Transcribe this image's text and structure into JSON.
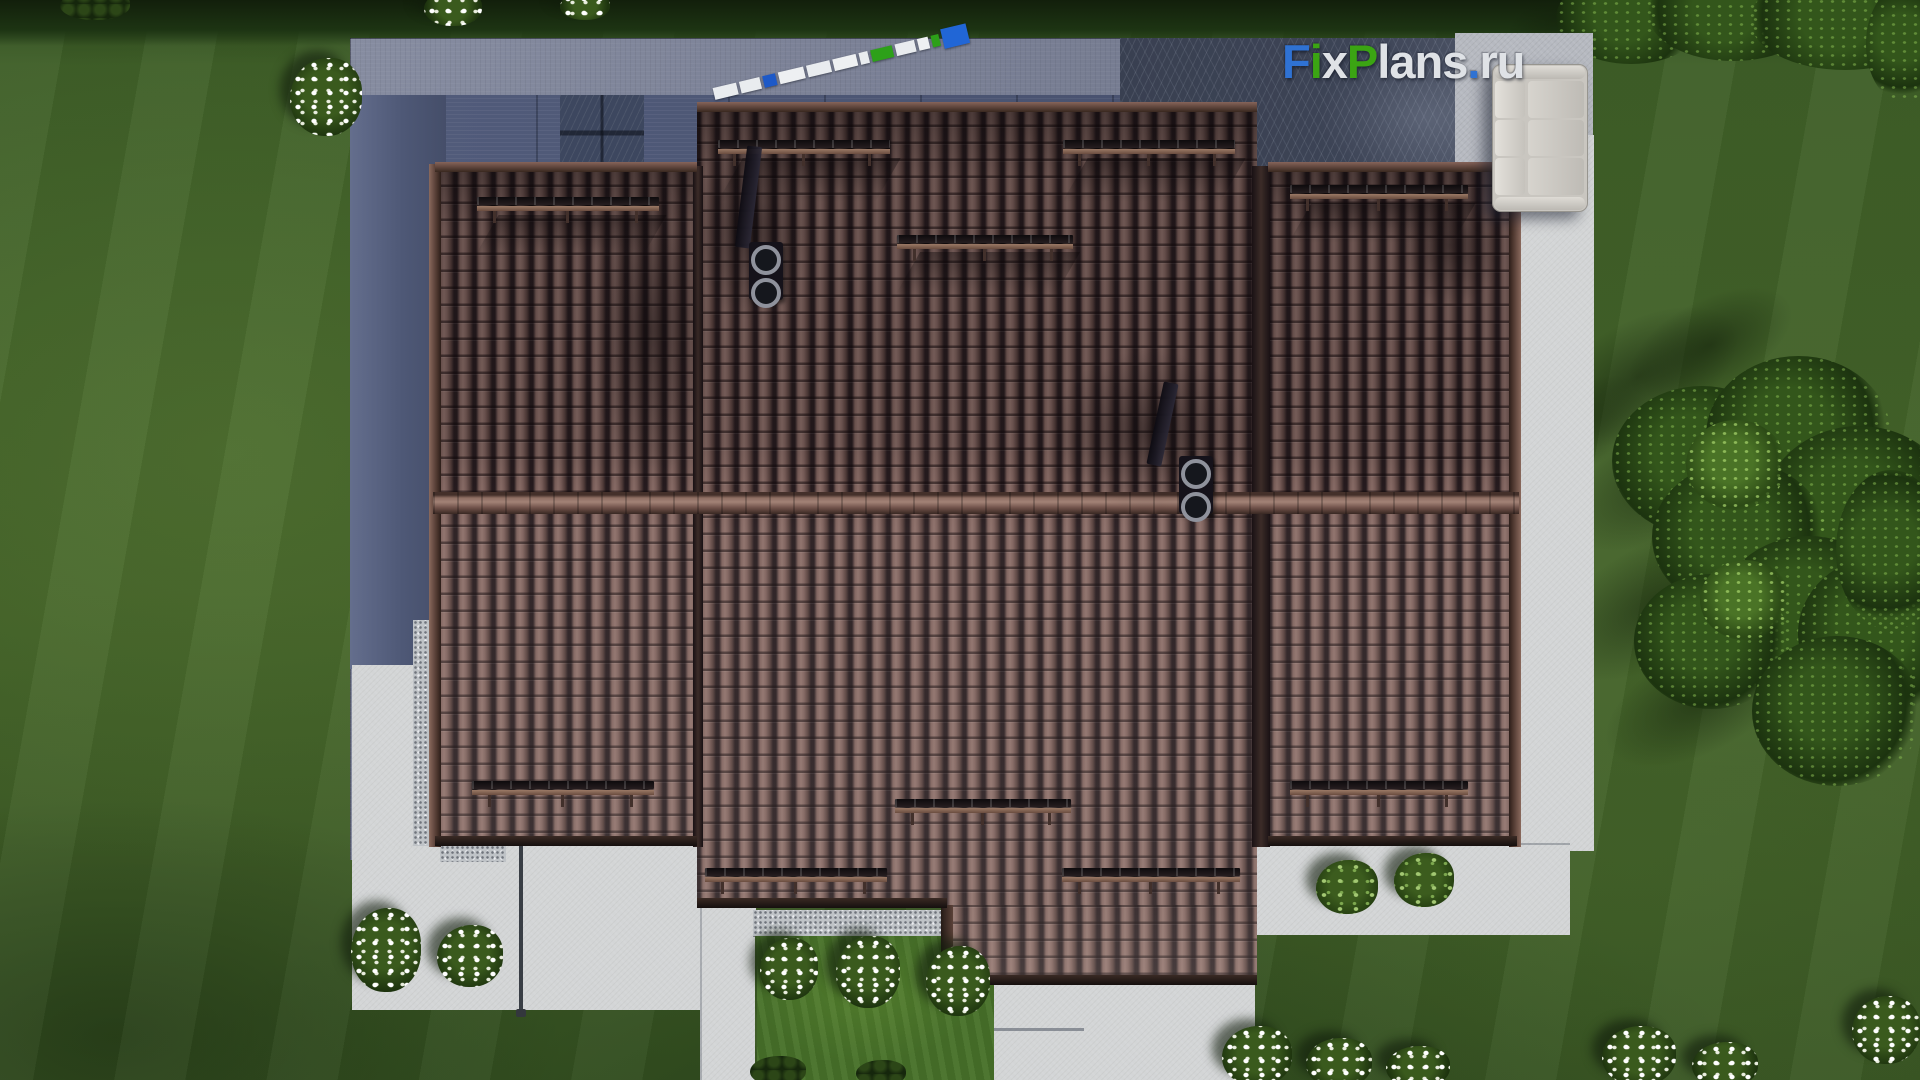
{
  "watermark": {
    "text": "FixPlans.ru",
    "parts": [
      {
        "text": "F",
        "style": "color:#2f72d3"
      },
      {
        "text": "i",
        "style": "color:#3ba413"
      },
      {
        "text": "x",
        "style": "color:#dfe2e6"
      },
      {
        "text": "P",
        "style": "color:#3ba413"
      },
      {
        "text": "lans",
        "style": "color:#dfe2e6"
      },
      {
        "text": ".",
        "style": "color:#2f72d3"
      },
      {
        "text": "ru",
        "style": "color:#dfe2e6"
      }
    ]
  },
  "palette": {
    "lawn": "#446329",
    "lawn_bright": "#4f7c2a",
    "roof_tile": "#7d615c",
    "roof_gap": "#271c1f",
    "ridge": "#8f6f64",
    "pavement_blue": "#7b8196",
    "pavement_dark": "#3a4153",
    "concrete": "#d3d5d6",
    "granite": "#bfc3c7",
    "shadow_blue": "#4e5876",
    "logo_blue": "#2f72d3",
    "logo_green": "#3ba413",
    "logo_white": "#dfe2e6",
    "ruler_white": "#e9ecef",
    "ruler_blue": "#1d59c8",
    "ruler_green": "#2da019",
    "tree_green": "#1c330f",
    "flower_white": "#ffffff"
  },
  "scene": {
    "ruler_segments": [
      {
        "style": "width:24px;background:#e9ecef"
      },
      {
        "style": "width:21px;background:#e9ecef"
      },
      {
        "style": "width:13px;background:#1d59c8"
      },
      {
        "style": "width:26px;background:#eef0f2"
      },
      {
        "style": "width:24px;background:#e9ecef"
      },
      {
        "style": "width:24px;background:#eef0f2"
      },
      {
        "style": "width:9px;background:#e9ecef"
      },
      {
        "style": "width:22px;background:#2da019"
      },
      {
        "style": "width:20px;background:#e9ecef"
      },
      {
        "style": "width:11px;background:#eef0f2"
      },
      {
        "style": "width:8px;background:#2da019"
      },
      {
        "style": "width:26px;background:#2166d6",
        "cls": "tip"
      }
    ],
    "snow_guards": [
      {
        "style": "left:477px;top:197px;width:182px"
      },
      {
        "style": "left:718px;top:140px;width:172px"
      },
      {
        "style": "left:1063px;top:140px;width:172px"
      },
      {
        "style": "left:897px;top:235px;width:176px"
      },
      {
        "style": "left:1290px;top:185px;width:178px"
      },
      {
        "style": "left:472px;top:781px;width:182px"
      },
      {
        "style": "left:895px;top:799px;width:176px"
      },
      {
        "style": "left:705px;top:868px;width:182px"
      },
      {
        "style": "left:1062px;top:868px;width:178px"
      },
      {
        "style": "left:1290px;top:781px;width:178px"
      }
    ],
    "roof_shadows": [
      {
        "style": "left:1050px;top:350px;width:200px;height:160px"
      },
      {
        "style": "left:690px;top:140px;width:120px;height:180px"
      },
      {
        "style": "left:590px;top:180px;width:120px;height:300px"
      },
      {
        "style": "left:1395px;top:185px;width:110px;height:120px"
      }
    ],
    "roof_streaks": [
      {
        "style": "left:730px;top:158px;width:158px;height:44px"
      },
      {
        "style": "left:1075px;top:158px;width:158px;height:44px"
      },
      {
        "style": "left:908px;top:252px;width:160px;height:42px"
      },
      {
        "style": "left:487px;top:215px;width:168px;height:40px"
      },
      {
        "style": "left:1300px;top:203px;width:164px;height:40px"
      }
    ],
    "flower_bushes": [
      {
        "style": "left:290px;top:58px;width:72px;height:78px"
      },
      {
        "style": "left:424px;top:-10px;width:58px;height:36px"
      },
      {
        "style": "left:560px;top:-8px;width:50px;height:28px"
      },
      {
        "style": "left:351px;top:908px;width:70px;height:84px"
      },
      {
        "style": "left:437px;top:925px;width:66px;height:62px"
      },
      {
        "style": "left:760px;top:938px;width:58px;height:62px"
      },
      {
        "style": "left:836px;top:936px;width:64px;height:72px"
      },
      {
        "style": "left:926px;top:946px;width:64px;height:70px"
      },
      {
        "style": "left:1222px;top:1026px;width:70px;height:60px"
      },
      {
        "style": "left:1306px;top:1038px;width:66px;height:50px"
      },
      {
        "style": "left:1386px;top:1046px;width:64px;height:42px"
      },
      {
        "style": "left:1602px;top:1026px;width:74px;height:60px"
      },
      {
        "style": "left:1692px;top:1042px;width:66px;height:46px"
      },
      {
        "style": "left:1852px;top:996px;width:68px;height:68px"
      },
      {
        "style": "left:1316px;top:860px;width:62px;height:54px",
        "cls": "green"
      },
      {
        "style": "left:1394px;top:853px;width:60px;height:54px",
        "cls": "green"
      },
      {
        "style": "left:750px;top:1056px;width:56px;height:30px",
        "cls": "dark"
      },
      {
        "style": "left:856px;top:1060px;width:50px;height:26px",
        "cls": "dark"
      },
      {
        "style": "left:60px;top:-10px;width:70px;height:30px",
        "cls": "dark"
      }
    ],
    "tree_shadows": [
      {
        "style": "left:1500px;top:-14px;width:130px;height:60px"
      },
      {
        "style": "left:1528px;top:322px;width:220px;height:110px"
      },
      {
        "style": "left:1556px;top:422px;width:230px;height:112px"
      },
      {
        "style": "left:1536px;top:544px;width:240px;height:120px"
      },
      {
        "style": "left:1596px;top:648px;width:210px;height:104px"
      },
      {
        "style": "left:1496px;top:386px;width:160px;height:84px"
      },
      {
        "style": "left:1620px;top:300px;width:180px;height:90px"
      }
    ],
    "tree_blobs": [
      {
        "style": "left:1556px;top:-28px;width:150px;height:92px"
      },
      {
        "style": "left:1648px;top:-34px;width:170px;height:95px"
      },
      {
        "style": "left:1750px;top:-30px;width:190px;height:100px"
      },
      {
        "style": "left:1866px;top:-16px;width:80px;height:120px"
      },
      {
        "style": "left:1612px;top:386px;width:180px;height:150px"
      },
      {
        "style": "left:1706px;top:356px;width:185px;height:160px"
      },
      {
        "style": "left:1762px;top:426px;width:195px;height:175px"
      },
      {
        "style": "left:1652px;top:462px;width:175px;height:150px"
      },
      {
        "style": "left:1716px;top:536px;width:185px;height:165px"
      },
      {
        "style": "left:1798px;top:556px;width:170px;height:155px"
      },
      {
        "style": "left:1634px;top:574px;width:155px;height:135px"
      },
      {
        "style": "left:1752px;top:636px;width:170px;height:150px"
      },
      {
        "style": "left:1836px;top:470px;width:110px;height:160px"
      },
      {
        "style": "left:1686px;top:420px;width:100px;height:90px",
        "cls": "lite"
      },
      {
        "style": "left:1700px;top:560px;width:90px;height:80px",
        "cls": "lite"
      }
    ]
  }
}
